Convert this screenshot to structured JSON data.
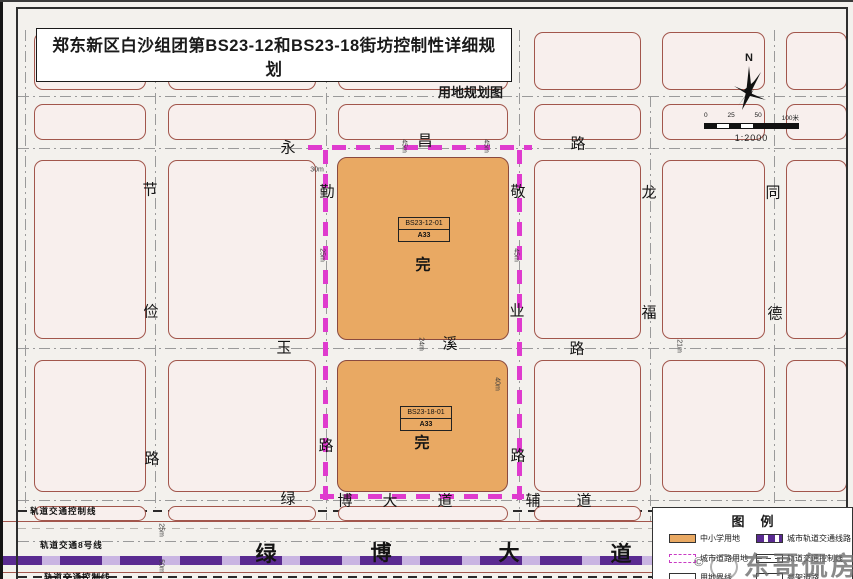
{
  "title_block": {
    "title": "郑东新区白沙组团第BS23-12和BS23-18街坊控制性详细规划",
    "subtitle": "用地规划图"
  },
  "compass": {
    "north_label": "N"
  },
  "scale_bar": {
    "tick_labels": [
      "0",
      "25",
      "50",
      "100米"
    ],
    "ratio": "1:2000"
  },
  "parcels": [
    {
      "code": "BS23-12-01",
      "land_use_code": "A33",
      "mark": "完"
    },
    {
      "code": "BS23-18-01",
      "land_use_code": "A33",
      "mark": "完"
    }
  ],
  "road_labels": [
    {
      "text": "永",
      "x": 288,
      "y": 147,
      "big": false
    },
    {
      "text": "昌",
      "x": 425,
      "y": 140,
      "big": false
    },
    {
      "text": "路",
      "x": 578,
      "y": 143,
      "big": false
    },
    {
      "text": "玉",
      "x": 284,
      "y": 347,
      "big": false
    },
    {
      "text": "溪",
      "x": 450,
      "y": 343,
      "big": false
    },
    {
      "text": "路",
      "x": 577,
      "y": 348,
      "big": false
    },
    {
      "text": "节",
      "x": 150,
      "y": 189,
      "big": false
    },
    {
      "text": "俭",
      "x": 151,
      "y": 311,
      "big": false
    },
    {
      "text": "路",
      "x": 152,
      "y": 458,
      "big": false
    },
    {
      "text": "勤",
      "x": 327,
      "y": 191,
      "big": false
    },
    {
      "text": "路",
      "x": 326,
      "y": 445,
      "big": false
    },
    {
      "text": "敬",
      "x": 518,
      "y": 191,
      "big": false
    },
    {
      "text": "业",
      "x": 517,
      "y": 310,
      "big": false
    },
    {
      "text": "路",
      "x": 518,
      "y": 455,
      "big": false
    },
    {
      "text": "龙",
      "x": 649,
      "y": 192,
      "big": false
    },
    {
      "text": "福",
      "x": 649,
      "y": 312,
      "big": false
    },
    {
      "text": "同",
      "x": 773,
      "y": 192,
      "big": false
    },
    {
      "text": "德",
      "x": 775,
      "y": 313,
      "big": false
    },
    {
      "text": "绿",
      "x": 288,
      "y": 498,
      "big": false
    },
    {
      "text": "博",
      "x": 345,
      "y": 500,
      "big": false
    },
    {
      "text": "大",
      "x": 390,
      "y": 500,
      "big": false
    },
    {
      "text": "道",
      "x": 445,
      "y": 500,
      "big": false
    },
    {
      "text": "辅",
      "x": 533,
      "y": 500,
      "big": false
    },
    {
      "text": "道",
      "x": 584,
      "y": 500,
      "big": false
    },
    {
      "text": "绿",
      "x": 266,
      "y": 553,
      "big": true
    },
    {
      "text": "博",
      "x": 381,
      "y": 552,
      "big": true
    },
    {
      "text": "大",
      "x": 509,
      "y": 552,
      "big": true
    },
    {
      "text": "道",
      "x": 621,
      "y": 553,
      "big": true
    }
  ],
  "dimension_labels": [
    {
      "text": "30m",
      "x": 317,
      "y": 170,
      "vertical": false
    },
    {
      "text": "45m",
      "x": 404,
      "y": 146,
      "vertical": true
    },
    {
      "text": "45m",
      "x": 486,
      "y": 146,
      "vertical": true
    },
    {
      "text": "25m",
      "x": 322,
      "y": 255,
      "vertical": true
    },
    {
      "text": "45m",
      "x": 516,
      "y": 255,
      "vertical": true
    },
    {
      "text": "24m",
      "x": 421,
      "y": 344,
      "vertical": true
    },
    {
      "text": "21m",
      "x": 679,
      "y": 346,
      "vertical": true
    },
    {
      "text": "40m",
      "x": 497,
      "y": 384,
      "vertical": true
    },
    {
      "text": "25m",
      "x": 161,
      "y": 530,
      "vertical": true
    },
    {
      "text": "50m",
      "x": 161,
      "y": 566,
      "vertical": true
    }
  ],
  "rail_notes": [
    "轨道交通控制线",
    "轨道交通8号线",
    "轨道交通控制线"
  ],
  "legend": {
    "title": "图例",
    "items_left": [
      {
        "swatch": "school-land",
        "label": "中小学用地"
      },
      {
        "swatch": "urban-road-land",
        "label": "城市道路用地"
      },
      {
        "swatch": "land-boundary",
        "label": "用地界线"
      }
    ],
    "items_right": [
      {
        "swatch": "urban-rail-line",
        "label": "城市轨道交通线路"
      },
      {
        "swatch": "rail-control-line",
        "label": "轨道交通控制线"
      },
      {
        "swatch": "rail-station",
        "label": "高架道路"
      }
    ]
  },
  "watermark": {
    "copyright": "©",
    "text": "东哥侃房"
  },
  "colors": {
    "parcel_fill": "#E9A963",
    "block_fill": "#F8EFED",
    "block_outline": "#A2564C",
    "boundary_magenta": "#DF3BCE",
    "rail_purple": "#5A2B91",
    "road_background": "#F3F1ED"
  }
}
